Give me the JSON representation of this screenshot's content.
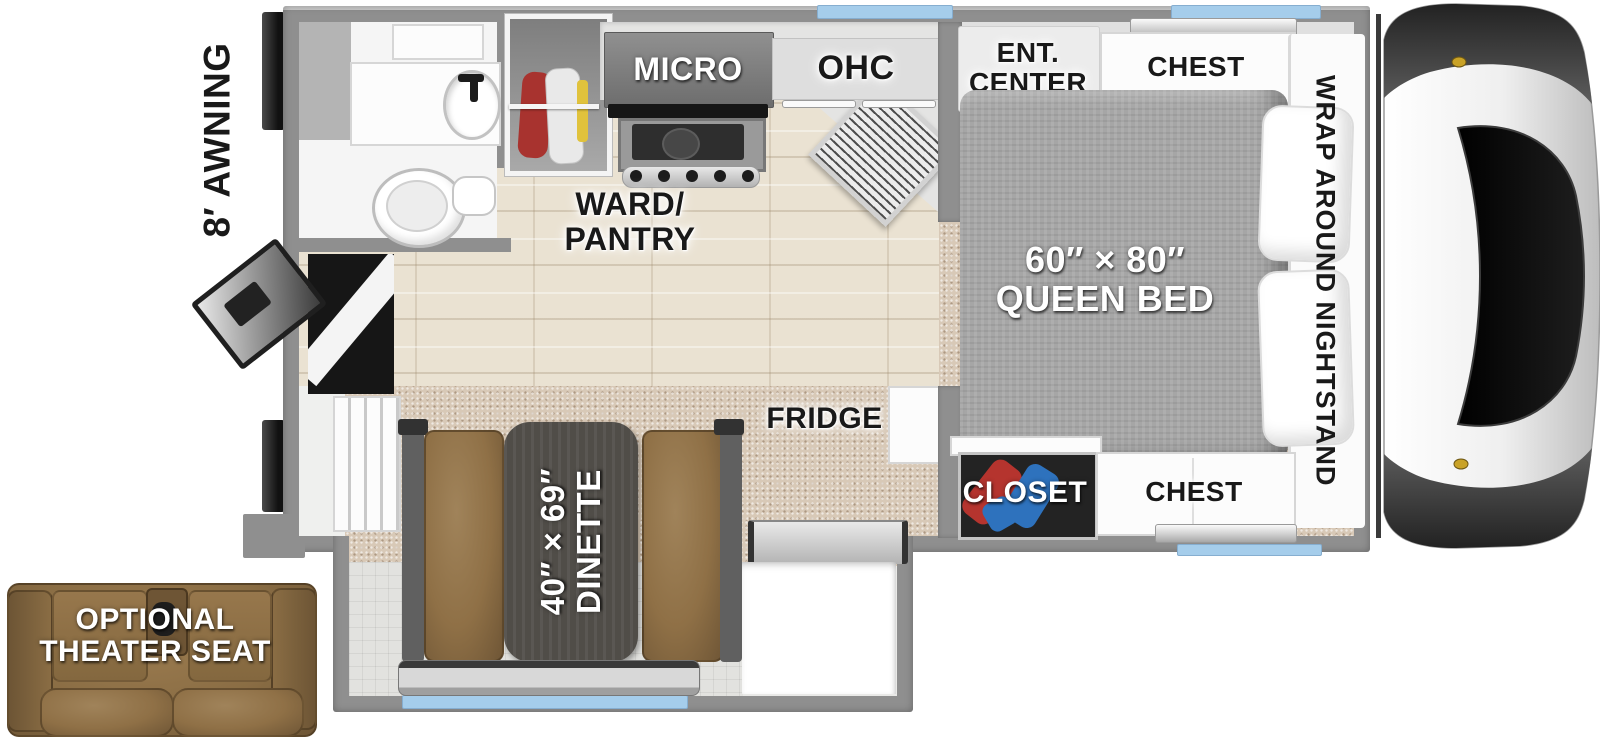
{
  "labels": {
    "awning": "8′ AWNING",
    "micro": "MICRO",
    "ohc": "OHC",
    "ent_center": [
      "ENT.",
      "CENTER"
    ],
    "chest_upper": "CHEST",
    "nightstand": "WRAP AROUND NIGHTSTAND",
    "ward_pantry": [
      "WARD/",
      "PANTRY"
    ],
    "queen_bed": [
      "60″ × 80″",
      "QUEEN BED"
    ],
    "fridge": "FRIDGE",
    "closet": "CLOSET",
    "chest_lower": "CHEST",
    "dinette": [
      "40″ × 69″",
      "DINETTE"
    ],
    "theater_seat": [
      "OPTIONAL",
      "THEATER SEAT"
    ]
  },
  "colors": {
    "wall": "#8f8f8f",
    "window": "#a5cdeb",
    "wood_floor": "#eae2d2",
    "carpet": "#d8c9b7",
    "tile": "#e2e2df",
    "bed": "#a6a6a6",
    "bench": "#8f7046",
    "table": "#504d48",
    "accent_tv": "#2f52b0"
  }
}
